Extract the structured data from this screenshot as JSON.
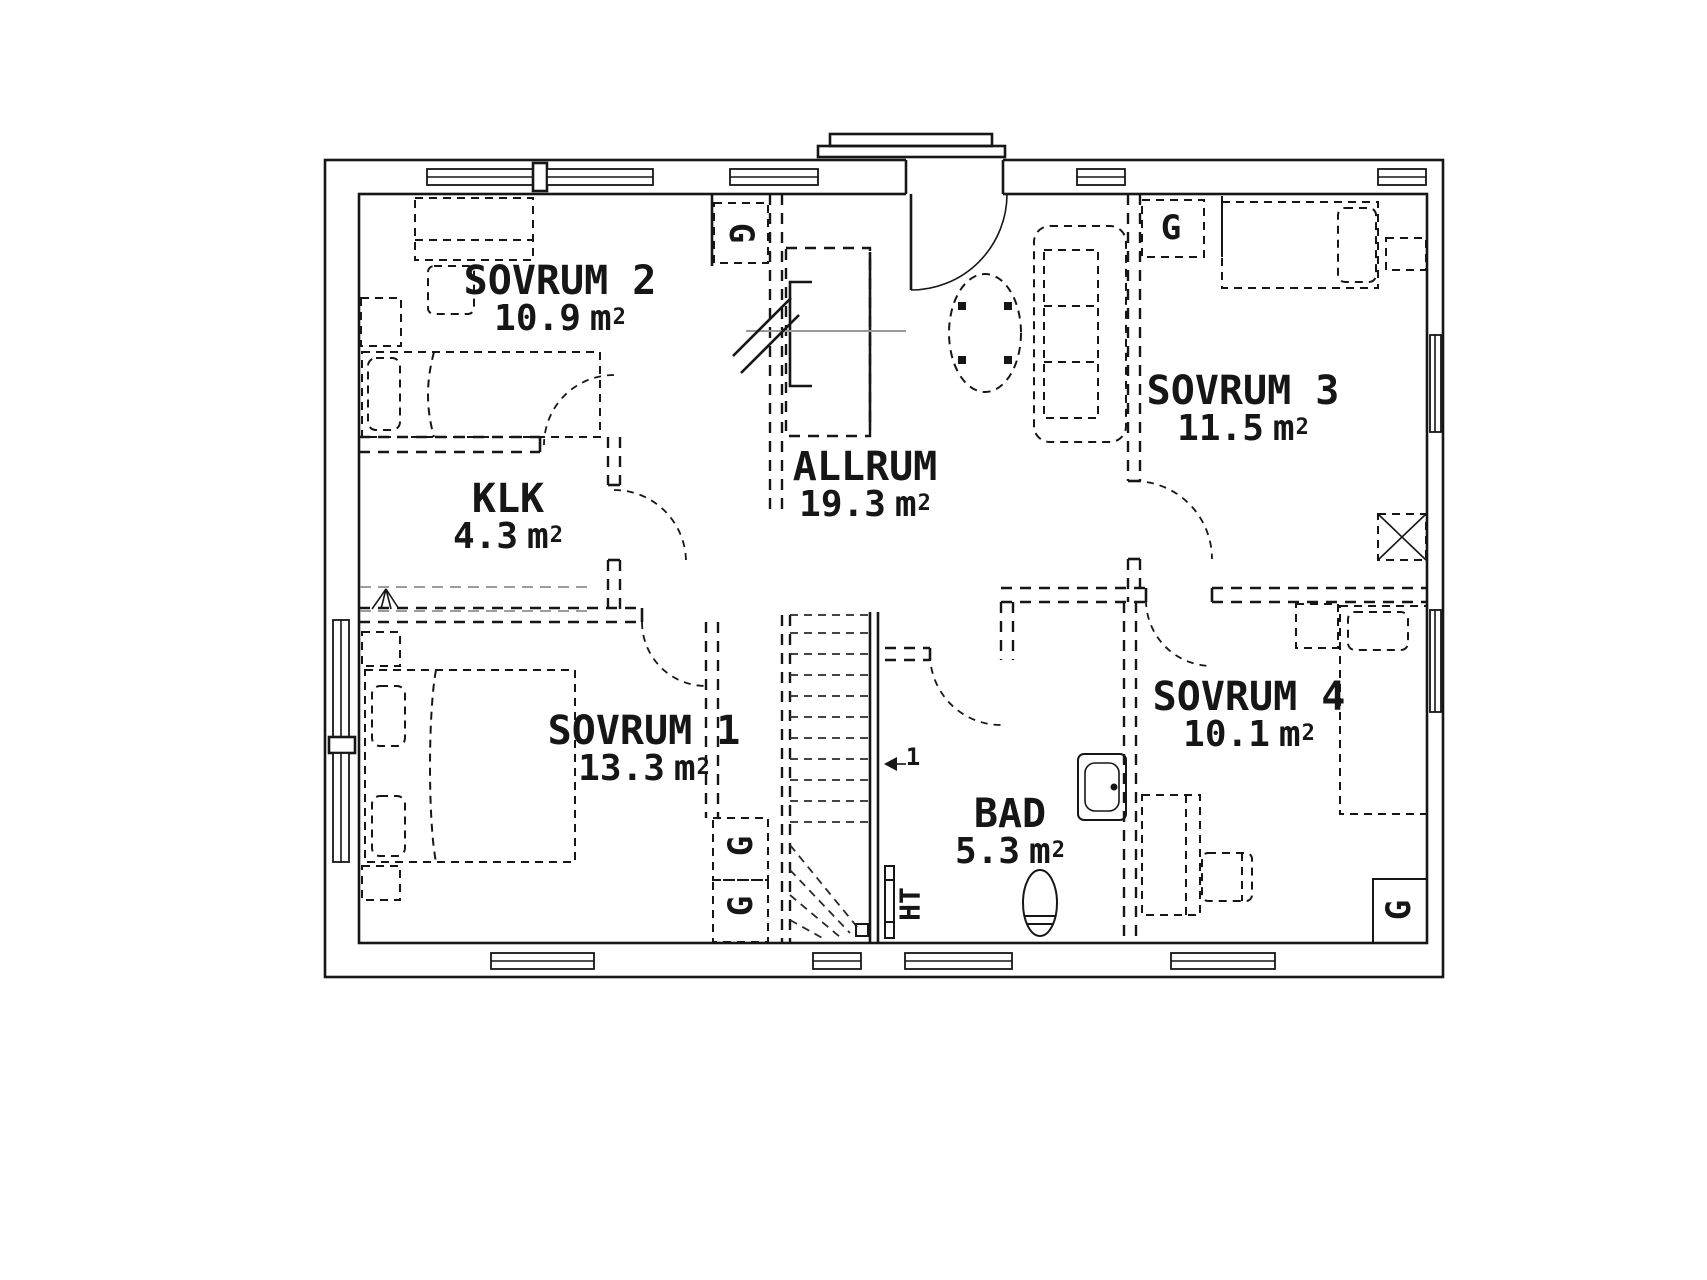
{
  "drawing": {
    "background": "#ffffff",
    "line_color": "#161616",
    "secondary_line_color": "#999999"
  },
  "rooms": [
    {
      "id": "sovrum-2",
      "name": "SOVRUM 2",
      "area": "10.9",
      "unit": "m",
      "exp": "2"
    },
    {
      "id": "klk",
      "name": "KLK",
      "area": "4.3",
      "unit": "m",
      "exp": "2"
    },
    {
      "id": "allrum",
      "name": "ALLRUM",
      "area": "19.3",
      "unit": "m",
      "exp": "2"
    },
    {
      "id": "sovrum-3",
      "name": "SOVRUM 3",
      "area": "11.5",
      "unit": "m",
      "exp": "2"
    },
    {
      "id": "sovrum-1",
      "name": "SOVRUM 1",
      "area": "13.3",
      "unit": "m",
      "exp": "2"
    },
    {
      "id": "sovrum-4",
      "name": "SOVRUM 4",
      "area": "10.1",
      "unit": "m",
      "exp": "2"
    },
    {
      "id": "bad",
      "name": "BAD",
      "area": "5.3",
      "unit": "m",
      "exp": "2"
    }
  ],
  "markers": {
    "wardrobe": "G",
    "towel_radiator": "HT",
    "stair_first_step": "1"
  }
}
